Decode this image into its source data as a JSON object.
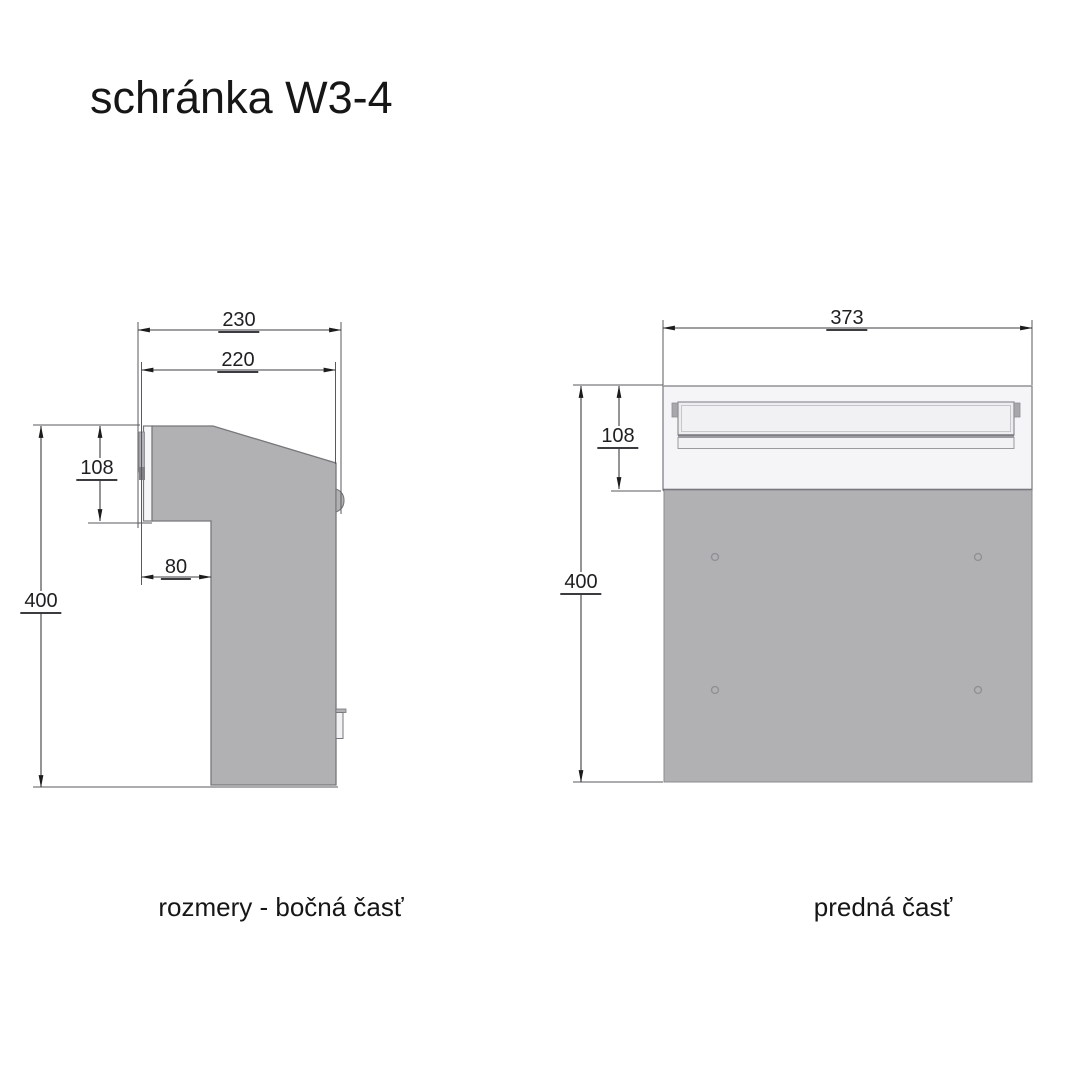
{
  "title": "schránka W3-4",
  "side_view": {
    "caption": "rozmery - bočná časť",
    "dims": {
      "total_depth": "230",
      "body_depth": "220",
      "door_height": "108",
      "foot_inset": "80",
      "total_height": "400"
    }
  },
  "front_view": {
    "caption": "predná časť",
    "dims": {
      "total_width": "373",
      "panel_height": "108",
      "total_height": "400"
    }
  },
  "colors": {
    "body_gray": "#b1b1b4",
    "panel_light": "#f5f5f8",
    "outline_gray": "#77777c",
    "dimension_line": "#3c3c40",
    "text": "#1c1c1c"
  }
}
